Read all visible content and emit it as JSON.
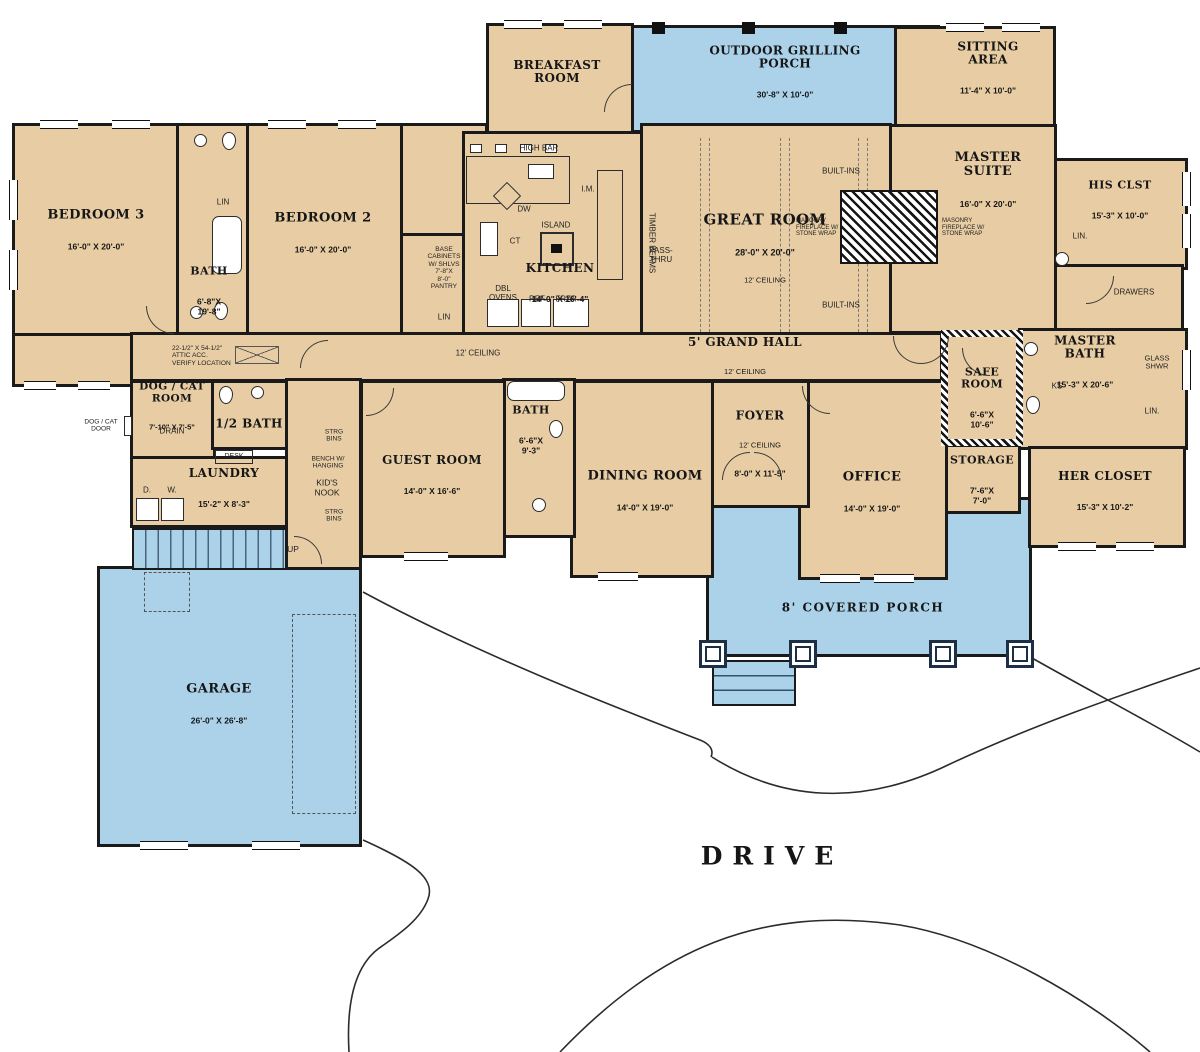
{
  "colors": {
    "wall": "#1a1a1a",
    "room_fill": "#e8cda4",
    "porch_fill": "#abd2e9",
    "background": "#ffffff"
  },
  "rooms": [
    {
      "name": "BEDROOM 3",
      "dims": "16'-0\" X 20'-0\""
    },
    {
      "name": "BATH",
      "dims": "6'-8\"X\n19'-8\""
    },
    {
      "name": "BEDROOM 2",
      "dims": "16'-0\" X 20'-0\""
    },
    {
      "name": "BREAKFAST\nROOM"
    },
    {
      "name": "OUTDOOR GRILLING\nPORCH",
      "dims": "30'-8\" X 10'-0\""
    },
    {
      "name": "SITTING\nAREA",
      "dims": "11'-4\" X 10'-0\""
    },
    {
      "name": "MASTER\nSUITE",
      "dims": "16'-0\" X 20'-0\""
    },
    {
      "name": "HIS CLST",
      "dims": "15'-3\" X 10'-0\""
    },
    {
      "name": "GREAT ROOM",
      "dims": "28'-0\" X 20'-0\"",
      "note": "12' CEILING"
    },
    {
      "name": "KITCHEN",
      "dims": "14'-0\" X 16'-4\""
    },
    {
      "name": "MASTER\nBATH",
      "dims": "15'-3\" X 20'-6\""
    },
    {
      "name": "HER CLOSET",
      "dims": "15'-3\" X 10'-2\""
    },
    {
      "name": "SAFE\nROOM",
      "dims": "6'-6\"X\n10'-6\""
    },
    {
      "name": "STORAGE",
      "dims": "7'-6\"X\n7'-0\""
    },
    {
      "name": "OFFICE",
      "dims": "14'-0\" X 19'-0\""
    },
    {
      "name": "FOYER",
      "dims": "8'-0\" X 11'-5\"",
      "note": "12' CEILING"
    },
    {
      "name": "DINING ROOM",
      "dims": "14'-0\" X 19'-0\""
    },
    {
      "name": "GUEST ROOM",
      "dims": "14'-0\" X 16'-6\""
    },
    {
      "name": "BATH",
      "dims": "6'-6\"X\n9'-3\""
    },
    {
      "name": "DOG / CAT\nROOM",
      "dims": "7'-10\" X 7'-5\""
    },
    {
      "name": "1/2 BATH"
    },
    {
      "name": "LAUNDRY",
      "dims": "15'-2\" X 8'-3\""
    },
    {
      "name": "GARAGE",
      "dims": "26'-0\" X 26'-8\""
    },
    {
      "name": "8' COVERED PORCH"
    },
    {
      "name": "5' GRAND HALL",
      "note": "12' CEILING"
    },
    {
      "name": "DRIVE"
    }
  ],
  "annotations": {
    "high_bar": "HIGH BAR",
    "dw": "DW",
    "ct": "CT",
    "island": "ISLAND",
    "im": "I.M.",
    "pass_thru": "PASS-\nTHRU",
    "timber": "TIMBER BEAMS",
    "dbl_ovens": "DBL\nOVENS",
    "ref": "REF",
    "frzr": "FRZR",
    "pantry": "BASE\nCABINETS\nW/ SHLVS\n7'-8\"X\n8'-0\"\nPANTRY",
    "lin": "LIN",
    "lin_dot": "LIN.",
    "ks": "KS",
    "glass_shwr": "GLASS\nSHWR",
    "drawers": "DRAWERS",
    "built_ins": "BUILT-INS",
    "masonry": "MASONRY\nFIREPLACE W/\nSTONE WRAP",
    "ceiling": "12' CEILING",
    "attic": "22-1/2\" X 54-1/2\"\nATTIC ACC.\nVERIFY LOCATION",
    "dogcat_door": "DOG / CAT\nDOOR",
    "drain": "DRAIN",
    "desk": "DESK",
    "d": "D.",
    "w": "W.",
    "kids_nook": "KID'S\nNOOK",
    "bench": "BENCH W/\nHANGING",
    "strg_bins": "STRG\nBINS",
    "up": "UP"
  }
}
